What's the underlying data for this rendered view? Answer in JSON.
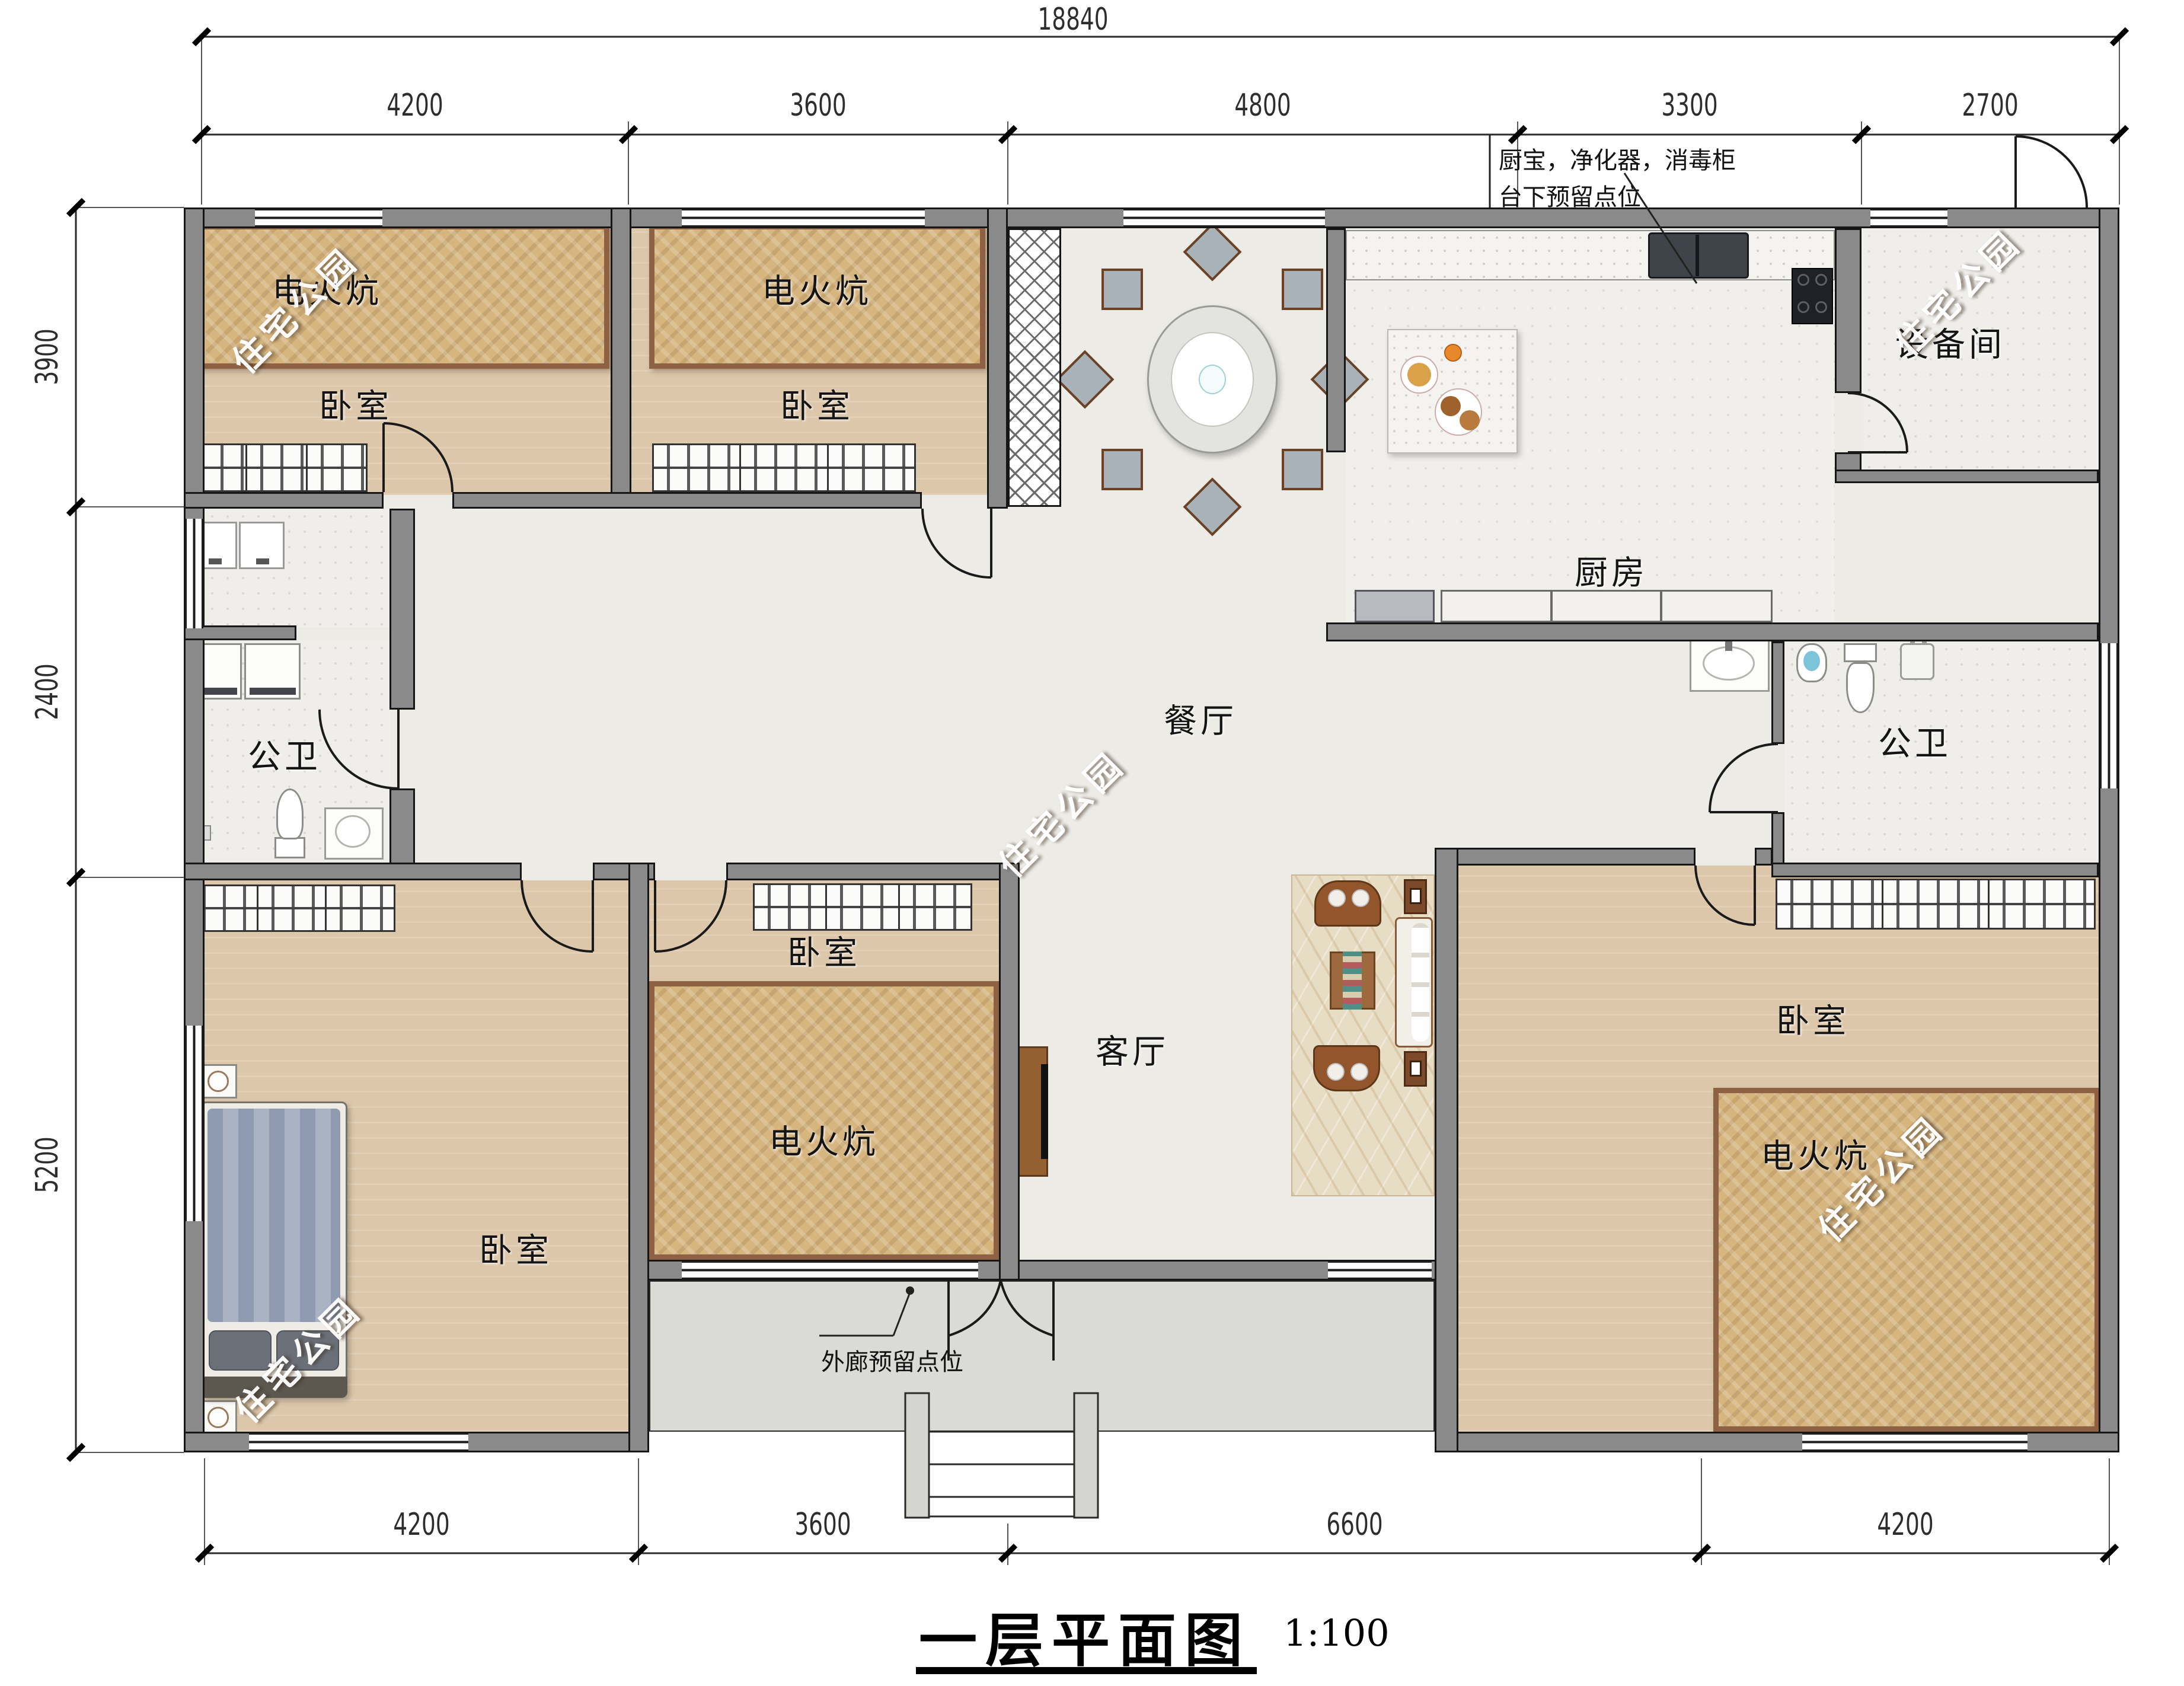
{
  "title": {
    "text": "一层平面图",
    "scale": "1:100"
  },
  "watermark": "住宅公园",
  "dimensions": {
    "total_width": "18840",
    "top": [
      "4200",
      "3600",
      "4800",
      "3300",
      "2700"
    ],
    "left": [
      "3900",
      "2400",
      "5200"
    ],
    "bottom": [
      "4200",
      "3600",
      "6600",
      "4200"
    ]
  },
  "labels": {
    "kang": "电火炕",
    "bedroom": "卧室",
    "bathroom": "公卫",
    "dining": "餐厅",
    "kitchen": "厨房",
    "utility": "设备间",
    "living": "客厅"
  },
  "annotations": {
    "kitchen_note_line1": "厨宝，净化器，消毒柜",
    "kitchen_note_line2": "台下预留点位",
    "porch_note": "外廊预留点位"
  },
  "colors": {
    "wall": "#8a8a8a",
    "kang_fill": "#d6b57f",
    "kang_frame": "#8f6144",
    "wood_floor": "#dcc7aa",
    "bath_floor": "#efeeeb",
    "hall_floor": "#edebe6",
    "porch_floor": "#dadad7",
    "furniture_brown": "#8a5a36"
  }
}
